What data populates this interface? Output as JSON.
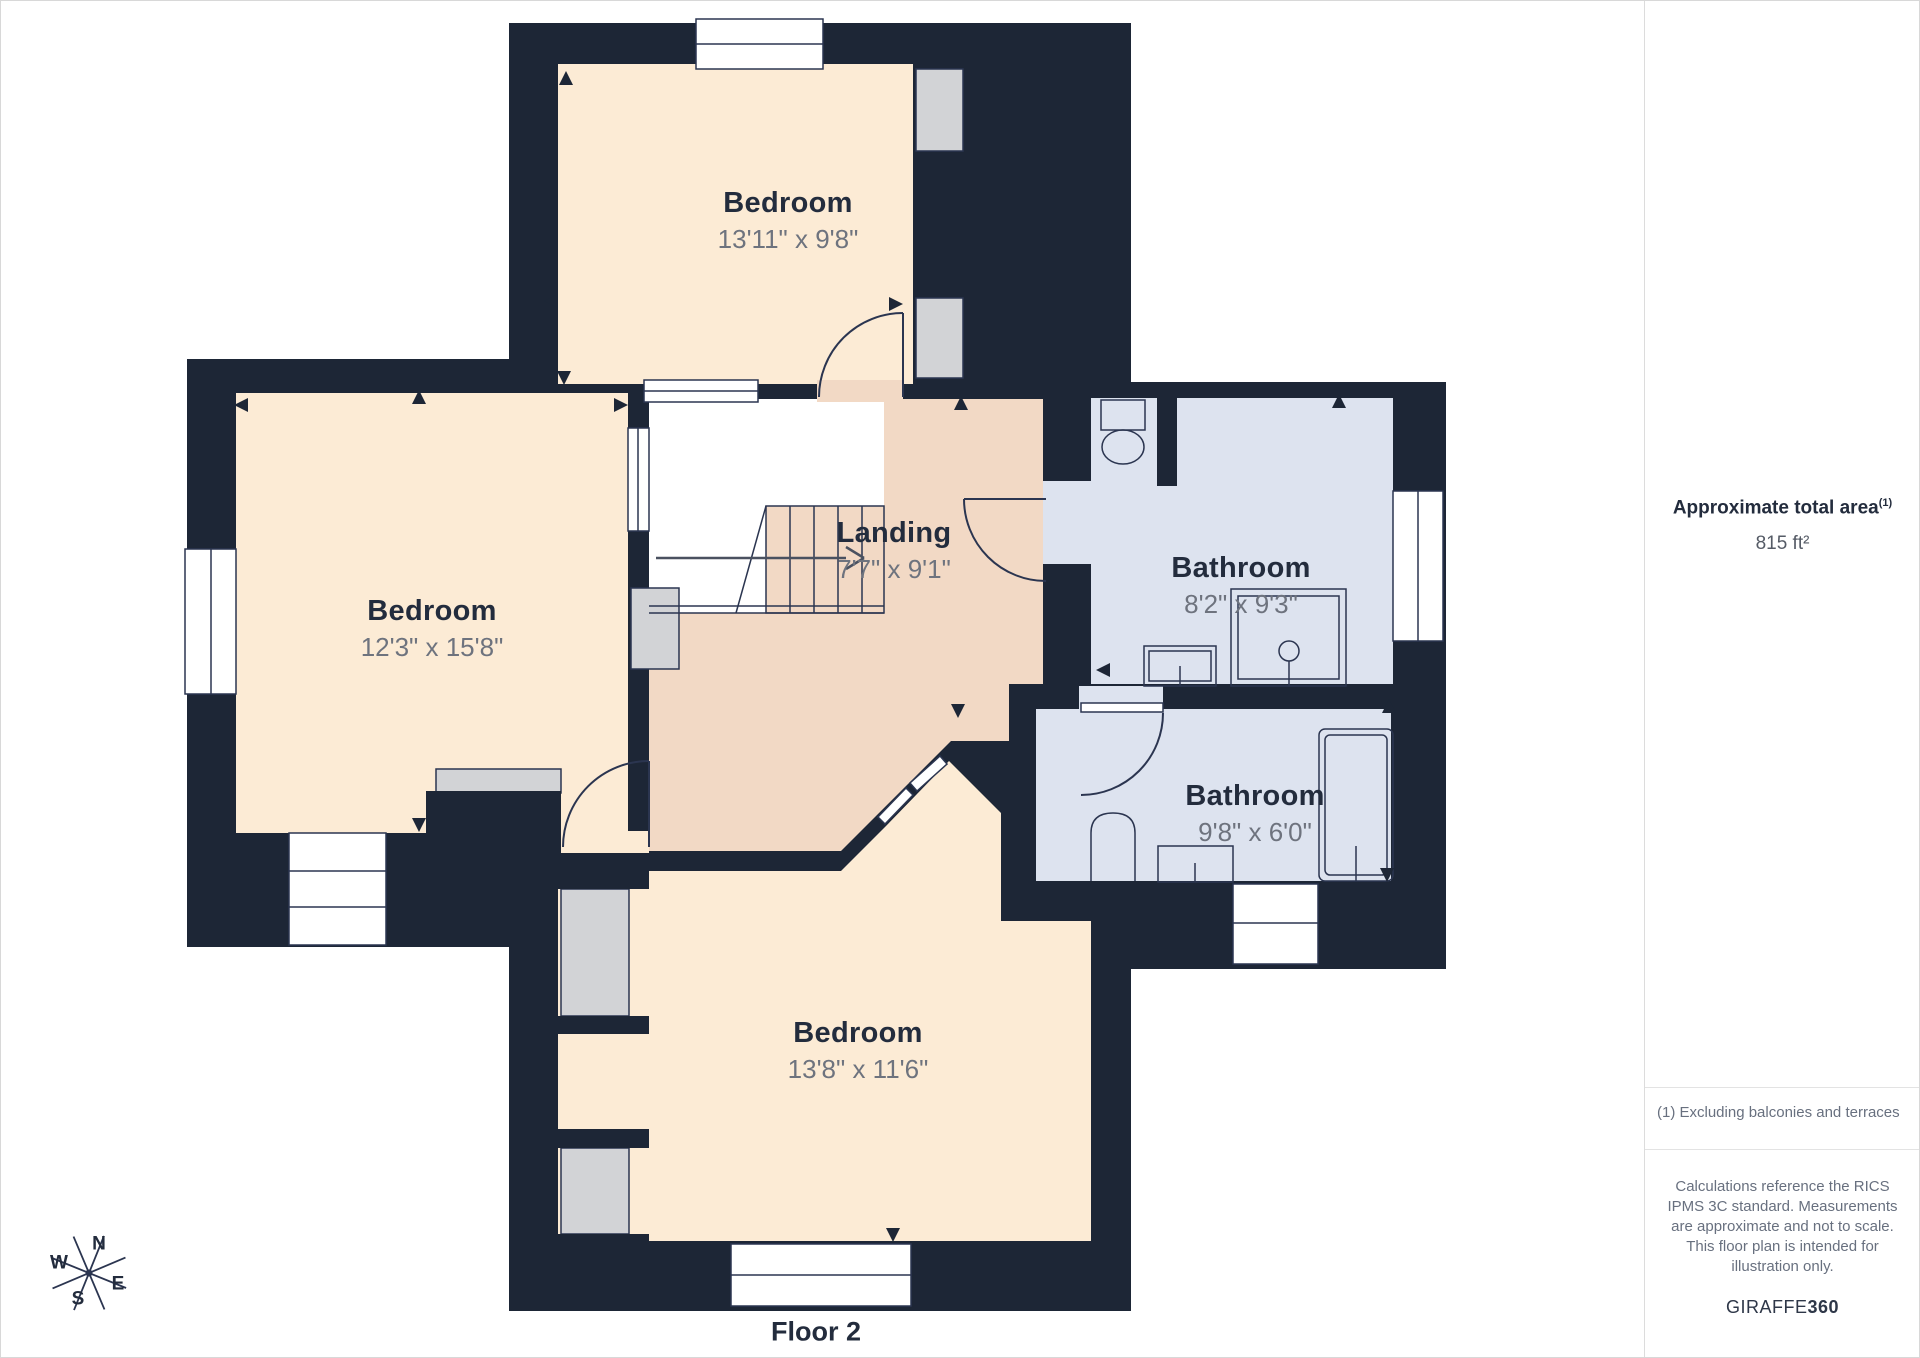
{
  "floor_label": "Floor 2",
  "rooms": [
    {
      "name": "Bedroom",
      "dimensions": "13'11\" x 9'8\""
    },
    {
      "name": "Bedroom",
      "dimensions": "12'3\" x 15'8\""
    },
    {
      "name": "Landing",
      "dimensions": "7'7\" x 9'1\""
    },
    {
      "name": "Bathroom",
      "dimensions": "8'2\" x 9'3\""
    },
    {
      "name": "Bathroom",
      "dimensions": "9'8\" x 6'0\""
    },
    {
      "name": "Bedroom",
      "dimensions": "13'8\" x 11'6\""
    }
  ],
  "compass": {
    "n": "N",
    "e": "E",
    "s": "S",
    "w": "W"
  },
  "sidebar": {
    "total_area_label": "Approximate total area",
    "total_area_superscript": "(1)",
    "total_area_value": "815 ft²",
    "footnote": "(1) Excluding balconies and terraces",
    "disclaimer": "Calculations reference the RICS IPMS 3C standard. Measurements are approximate and not to scale. This floor plan is intended for illustration only.",
    "brand": "GIRAFFE",
    "brand_suffix": "360"
  },
  "colors": {
    "wall": "#1d2636",
    "bedroom_fill": "#fcebd5",
    "landing_fill": "#f2d9c5",
    "bathroom_fill": "#dde3ef",
    "closet_fill": "#d2d3d6",
    "title_text": "#232c3d",
    "muted_text": "#6e737e"
  }
}
